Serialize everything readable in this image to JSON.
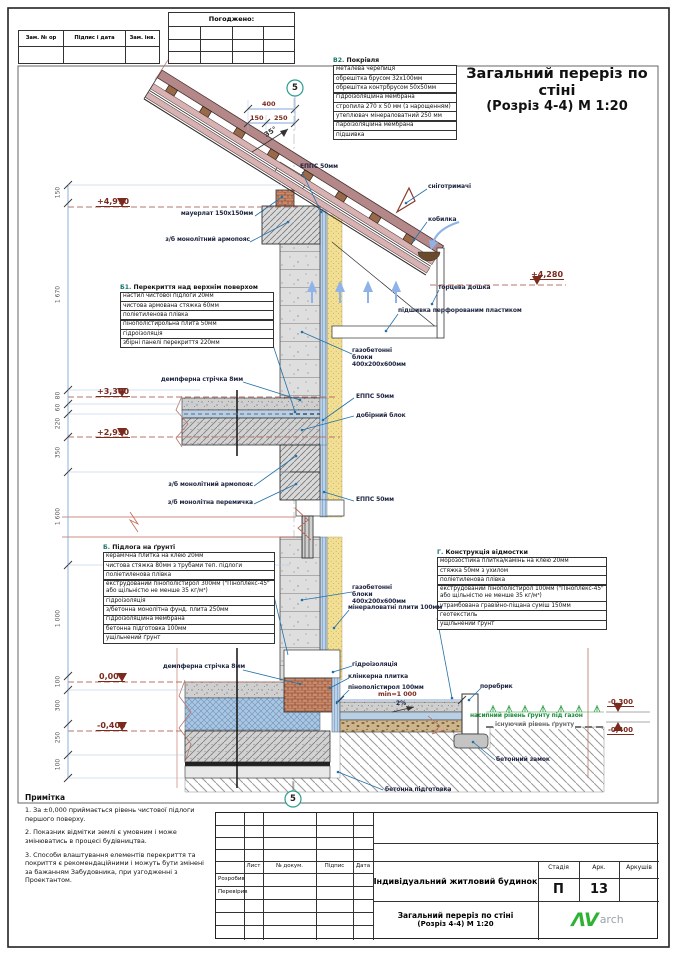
{
  "sheet": {
    "stamp_cells": [
      "Зам. № ор",
      "Підпис і дата",
      "Зам. інв. №"
    ],
    "approved_label": "Погоджено:"
  },
  "title": {
    "line1": "Загальний переріз по стіні",
    "line2": "(Розріз 4-4)  М 1:20"
  },
  "callouts": {
    "roof": {
      "title_code": "В2.",
      "title": "Покрівля",
      "items": [
        "металева черепиця",
        "обрешітка брусом 32х100мм",
        "обрешітка контрбрусом 50х50мм",
        "гідроізоляційна мембрана",
        "стропила 270 х 50 мм (з нарощенням)",
        "утеплювач мінераловатний 250 мм",
        "пароізоляційна мембрана",
        "підшивка"
      ]
    },
    "ceiling": {
      "title_code": "Б1.",
      "title": "Перекриття над верхнім поверхом",
      "items": [
        "настил чистової підлоги 20мм",
        "чистова армована стяжка 60мм",
        "поліетиленова плівка",
        "пінополістирольна плита 50мм",
        "гідроізоляція",
        "збірні панелі перекриття 220мм"
      ]
    },
    "floor": {
      "title_code": "Б.",
      "title": "Підлога на ґрунті",
      "items": [
        "керамічна плитка на клею 20мм",
        "чистова стяжка 80мм з трубами теп. підлоги",
        "поліетиленова плівка",
        "екструдований пінополістирол 300мм (\"Піноплекс-45\" або щільністю не менше 35 кг/м³)",
        "гідроізоляція",
        "з/бетонна монолітна фунд. плита 250мм",
        "гідроізоляційна мембрана",
        "бетонна підготовка 100мм",
        "ущільнений ґрунт"
      ]
    },
    "apron": {
      "title_code": "Г.",
      "title": "Конструкція відмостки",
      "items": [
        "морозостійка плитка/камінь на клею 20мм",
        "стяжка 50мм з ухилом",
        "поліетиленова плівка",
        "екструдований пінополістирол 100мм (\"Піноплекс-45\" або щільністю не менше 35 кг/м³)",
        "утрамбована гравійно-піщана суміш 150мм",
        "геотекстиль",
        "ущільнений ґрунт"
      ]
    }
  },
  "labels": {
    "epps": "ЕППС 50мм",
    "snow_guard": "сніготримачі",
    "kobylka": "кобилка",
    "fascia": "торцева дошка",
    "soffit": "підшивка перфорованим пластиком",
    "mauerlat": "мауерлат 150х150мм",
    "armopoias": "з/б монолітний армопояс",
    "lintel": "з/б монолітна перемичка",
    "damper": "демпферна стрічка 8мм",
    "gas_blocks": "газобетонні блоки 400х200х600мм",
    "extra_block": "добірний блок",
    "minwool": "мінераловатні плити 100мм",
    "waterproofing": "гідроізоляція",
    "clinker": "клінкерна плитка",
    "eps100": "пінополістирол 100мм",
    "curb": "поребрик",
    "fill_level": "насипний рівень ґрунту під газон",
    "existing_level": "існуючий рівень ґрунту",
    "concrete_lock": "бетонний замок",
    "blinding": "бетонна підготовка"
  },
  "levels": {
    "l4970": "+4,970",
    "l4280": "+4,280",
    "l3300": "+3,300",
    "l2950": "+2,950",
    "l0": "0,000",
    "lm400": "-0,400",
    "rm300": "-0,300"
  },
  "dims": {
    "left": [
      "150",
      "1 670",
      "80",
      "60",
      "220",
      "350",
      "1 600",
      "1 000",
      "100",
      "300",
      "250",
      "100"
    ],
    "top_total": "400",
    "top_left": "150",
    "top_right": "250",
    "angle": "35°",
    "marker": "5",
    "min_width": "min=1 000",
    "slope": "2%"
  },
  "notes": {
    "title": "Примітка",
    "n1": "1. За ±0,000 приймається рівень чистової підлоги першого поверху.",
    "n2": "2. Показник відмітки землі є умовним і може змінюватись в процесі будівництва.",
    "n3": "3. Способи влаштування елементів перекриття та покриття є рекомендаційними і можуть бути змінені за бажанням Забудовника, при узгодженні з Проектантом."
  },
  "titleblock": {
    "cols": [
      "Лист",
      "№ докум.",
      "Підпис",
      "Дата"
    ],
    "row1": "Розробив",
    "row2": "Перевірив",
    "object": "Індивідуальний житловий будинок",
    "t1": "Загальний переріз по стіні",
    "t2": "(Розріз 4-4)  М 1:20",
    "stage_label": "Стадія",
    "sheet_label": "Арк.",
    "sheets_label": "Аркушів",
    "stage": "П",
    "sheet_no": "13",
    "logo_mark": "ΛV",
    "logo_text": "arch"
  },
  "colors": {
    "leader_blue": "#2471a8",
    "dim_blue": "#7fa8d8",
    "level_maroon": "#7b2a1e",
    "detail_teal": "#2a9d8f",
    "logo_green": "#2db233",
    "wall_yellow": "#f2df96",
    "insulation_blue": "#a9c6e2",
    "roof_tile": "#b48888",
    "grass_green": "#2f9e44"
  }
}
